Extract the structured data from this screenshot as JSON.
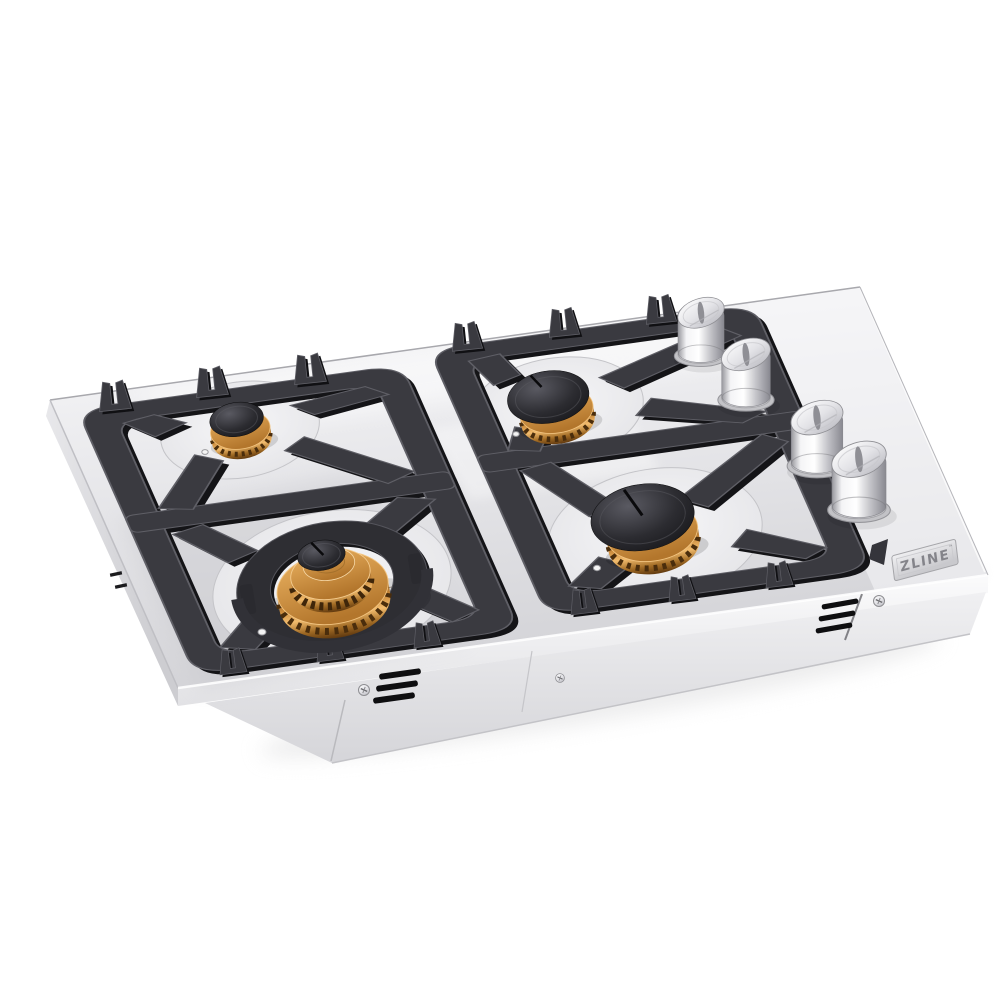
{
  "meta": {
    "type": "product-photo",
    "description": "Stainless steel 4-burner drop-in gas cooktop with black cast-iron grates, brass burners and stainless control knobs, three-quarter view on white background"
  },
  "badge": {
    "brand": "ZLINE",
    "trademark_symbol": "™"
  },
  "palette": {
    "background": "#ffffff",
    "stainless_light": "#fafafb",
    "stainless": "#e6e6e9",
    "stainless_dark": "#cfcfd3",
    "grate": "#3a3a40",
    "grate_shadow": "#141417",
    "grate_highlight": "#5f5f66",
    "brass": "#c9893a",
    "brass_highlight": "#f2bc6e",
    "brass_dark": "#60390f",
    "burner_cap": "#2c2c31",
    "knob_silver": "#d6d6da",
    "badge_text": "#84848a",
    "vent_black": "#0e0e10"
  },
  "components": {
    "grates": {
      "count": 2,
      "material": "black cast iron",
      "style": "flat with finger prongs"
    },
    "burners": [
      {
        "id": "rear-left",
        "size": "small",
        "ring": "brass",
        "cap": "black"
      },
      {
        "id": "rear-right",
        "size": "medium",
        "ring": "brass",
        "cap": "black"
      },
      {
        "id": "front-left",
        "size": "large dual-ring",
        "ring": "brass",
        "cap": "black"
      },
      {
        "id": "front-right",
        "size": "medium-large",
        "ring": "brass",
        "cap": "black"
      }
    ],
    "knobs": {
      "count": 4,
      "finish": "stainless steel",
      "layout": "right side, two staggered pairs"
    },
    "vents": {
      "front_left_slots": 3,
      "right_slots": 3,
      "screws": 3
    }
  }
}
